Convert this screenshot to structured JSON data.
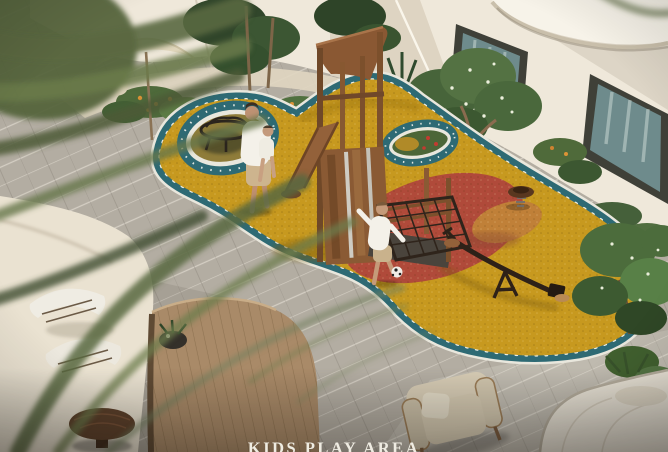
{
  "caption": {
    "text": "KIDS PLAY AREA"
  },
  "palette": {
    "wall": "#efe8da",
    "wall_shade": "#ded4c2",
    "glass": "#6e8b8c",
    "paving": "#b3ada2",
    "sand": "#eae2d1",
    "walkway": "#e0d6c1",
    "rubber_yellow": "#c7991f",
    "rubber_red": "#b04a3a",
    "rubber_orange": "#c08038",
    "band_teal": "#2e6a74",
    "band_edge": "#e9e7dd",
    "wood": "#93613a",
    "wood_dark": "#6f4828",
    "foliage": "#4c6c3c",
    "palm": "#5a6840",
    "deck": "#a98a68",
    "cushion": "#d6cbb4",
    "caption_color": "#efece2"
  },
  "objects": [
    {
      "name": "kids-play-area",
      "kind": "playground render"
    },
    {
      "name": "play-tower",
      "kind": "wooden play structure with slide"
    },
    {
      "name": "seesaw",
      "kind": "metal seesaw"
    },
    {
      "name": "climbing-net",
      "kind": "rope net"
    },
    {
      "name": "spring-rider",
      "kind": "spring toy"
    },
    {
      "name": "people",
      "kind": "adult with child, boy with ball"
    }
  ]
}
